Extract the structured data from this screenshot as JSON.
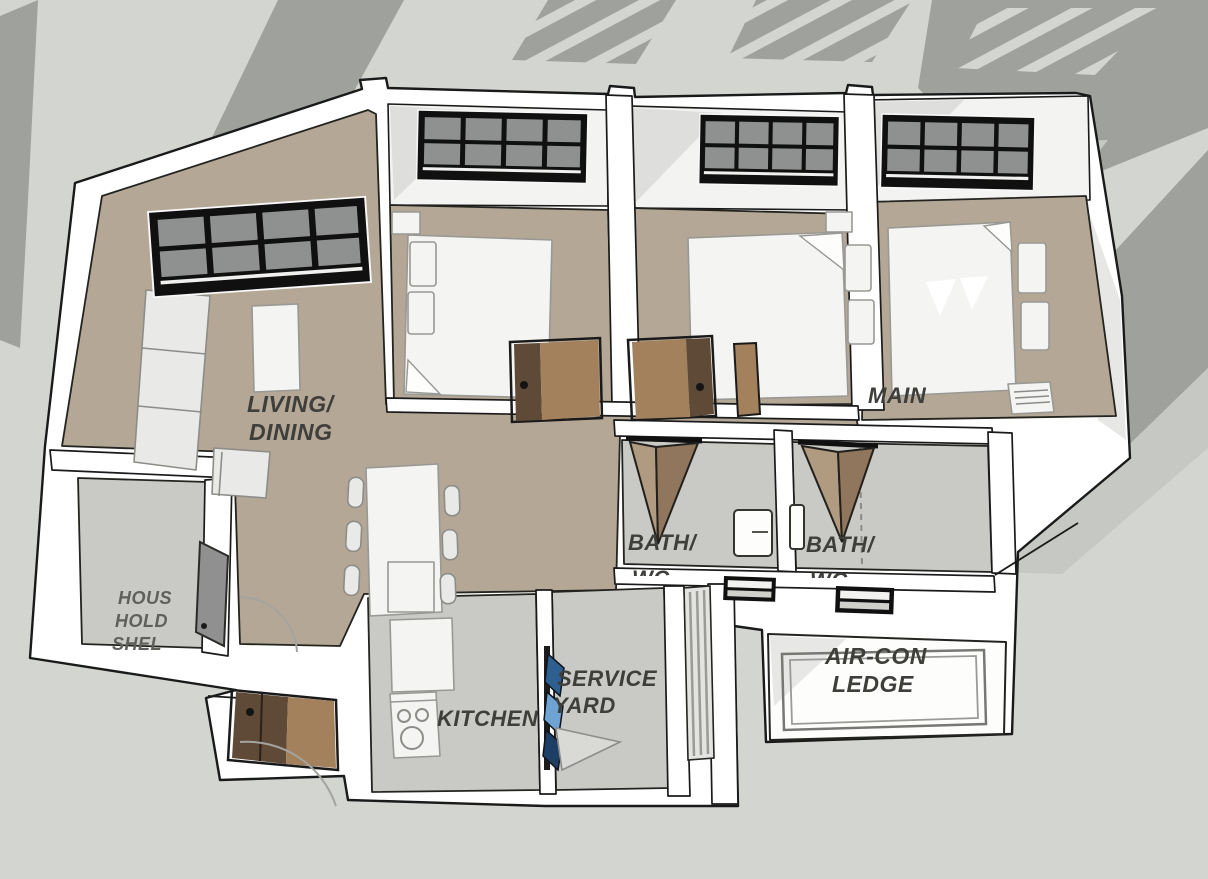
{
  "labels": {
    "living": [
      "LIVING/",
      "DINING"
    ],
    "main": "MAIN",
    "bath1": [
      "BATH/",
      "WC"
    ],
    "bath2": [
      "BATH/",
      "WC"
    ],
    "shelter": [
      "HOUS",
      "HOLD",
      "SHEL"
    ],
    "kitchen": "KITCHEN",
    "service": [
      "SERVICE",
      "YARD"
    ],
    "aircon": [
      "AIR-CON",
      "LEDGE"
    ]
  },
  "colors": {
    "background": "#d3d5d0",
    "shadow": "#9fa19d",
    "shadow_light": "#c6c8c3",
    "wall": "#ffffff",
    "outline": "#1a1a1a",
    "floor_tan": "#b4a796",
    "floor_gray": "#c9c9c6",
    "furniture": "#e9e9e7",
    "window_frame": "#101010",
    "window_glass": "#8f9190",
    "door_brown_dark": "#5f4a38",
    "door_brown_light": "#a3815c",
    "label_text": "#3e3e3b",
    "ladder_blue": "#2e5f91"
  }
}
